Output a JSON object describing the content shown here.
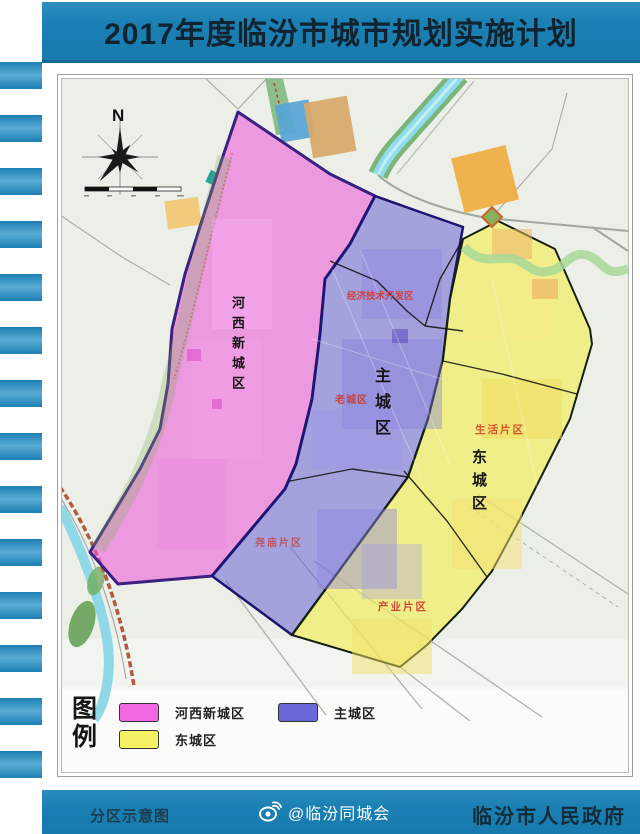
{
  "title": "2017年度临汾市城市规划实施计划",
  "map": {
    "north_label": "N",
    "zone_labels": {
      "hexi": "河西新城区",
      "zhucheng": "主城区",
      "dongcheng": "东城区"
    },
    "subzone_labels": {
      "jingjikaifa": "经济技术开发区",
      "laocheng": "老城区",
      "yaomiao": "尧庙片区",
      "shenghuo": "生活片区",
      "chanye": "产业片区"
    }
  },
  "legend": {
    "title_line1": "图",
    "title_line2": "例",
    "items": [
      {
        "label": "河西新城区",
        "color": "#f168e2"
      },
      {
        "label": "主城区",
        "color": "#6a68d8"
      },
      {
        "label": "东城区",
        "color": "#f5f165"
      }
    ]
  },
  "footer": {
    "left_label": "分区示意图",
    "watermark": "@临汾同城会",
    "right_label": "临汾市人民政府"
  },
  "colors": {
    "banner": "#1b80b4",
    "zone_hexi_fill": "#ee52d8",
    "zone_main_fill": "#5a55d2",
    "zone_east_fill": "#f2ee4e",
    "subzone_label_red": "#d0413c"
  }
}
